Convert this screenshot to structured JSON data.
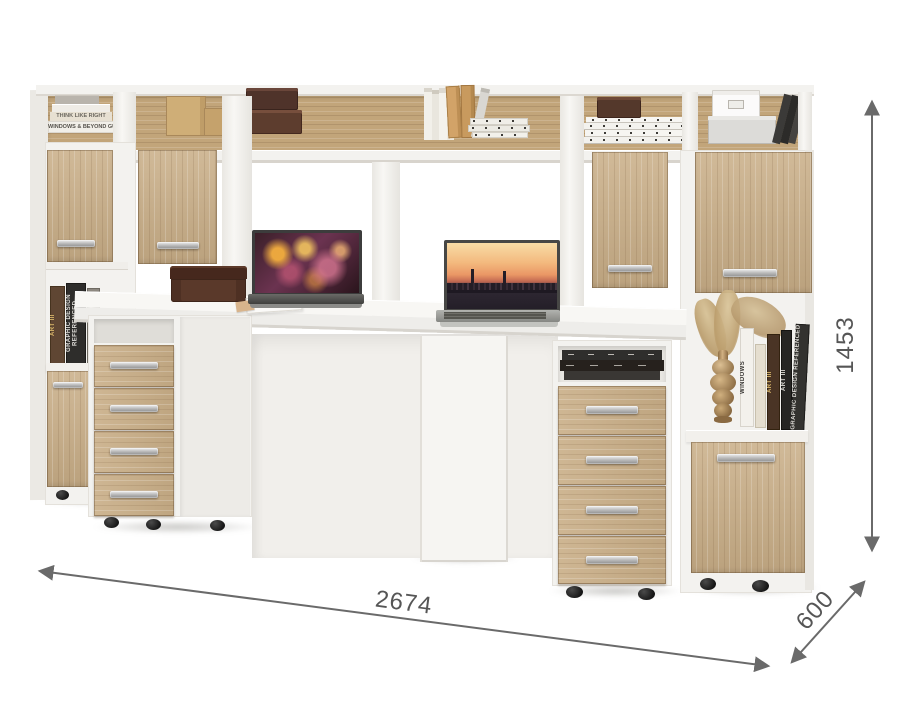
{
  "scene": {
    "description": "White and sonoma-oak two-person computer desk wall unit with bookcase towers, hutch shelf, two drawer pedestals, two laptops and shelf decor",
    "background_color": "#ffffff"
  },
  "dimensions": {
    "width": "2674",
    "depth": "600",
    "height": "1453",
    "line_color": "#6a6a6a",
    "label_color": "#565656"
  },
  "materials": {
    "wood_hex": "#c9ae87",
    "wood_back_hex": "#c2a57a",
    "white_panel_hex": "#f3f2ef",
    "handle_hex": "#b9b9b9"
  },
  "decor": {
    "books": {
      "left_top_a": "THINK LIKE RIGHT",
      "left_top_b": "WINDOWS & BEYOND GUIDE",
      "left_shelf_a": "ART III",
      "left_shelf_b": "GRAPHIC DESIGN REFERENCED",
      "right_shelf_a": "WINDOWS",
      "right_shelf_b": "ART III",
      "right_shelf_c": "ART III",
      "right_shelf_d": "GRAPHIC DESIGN REFERENCED"
    }
  }
}
